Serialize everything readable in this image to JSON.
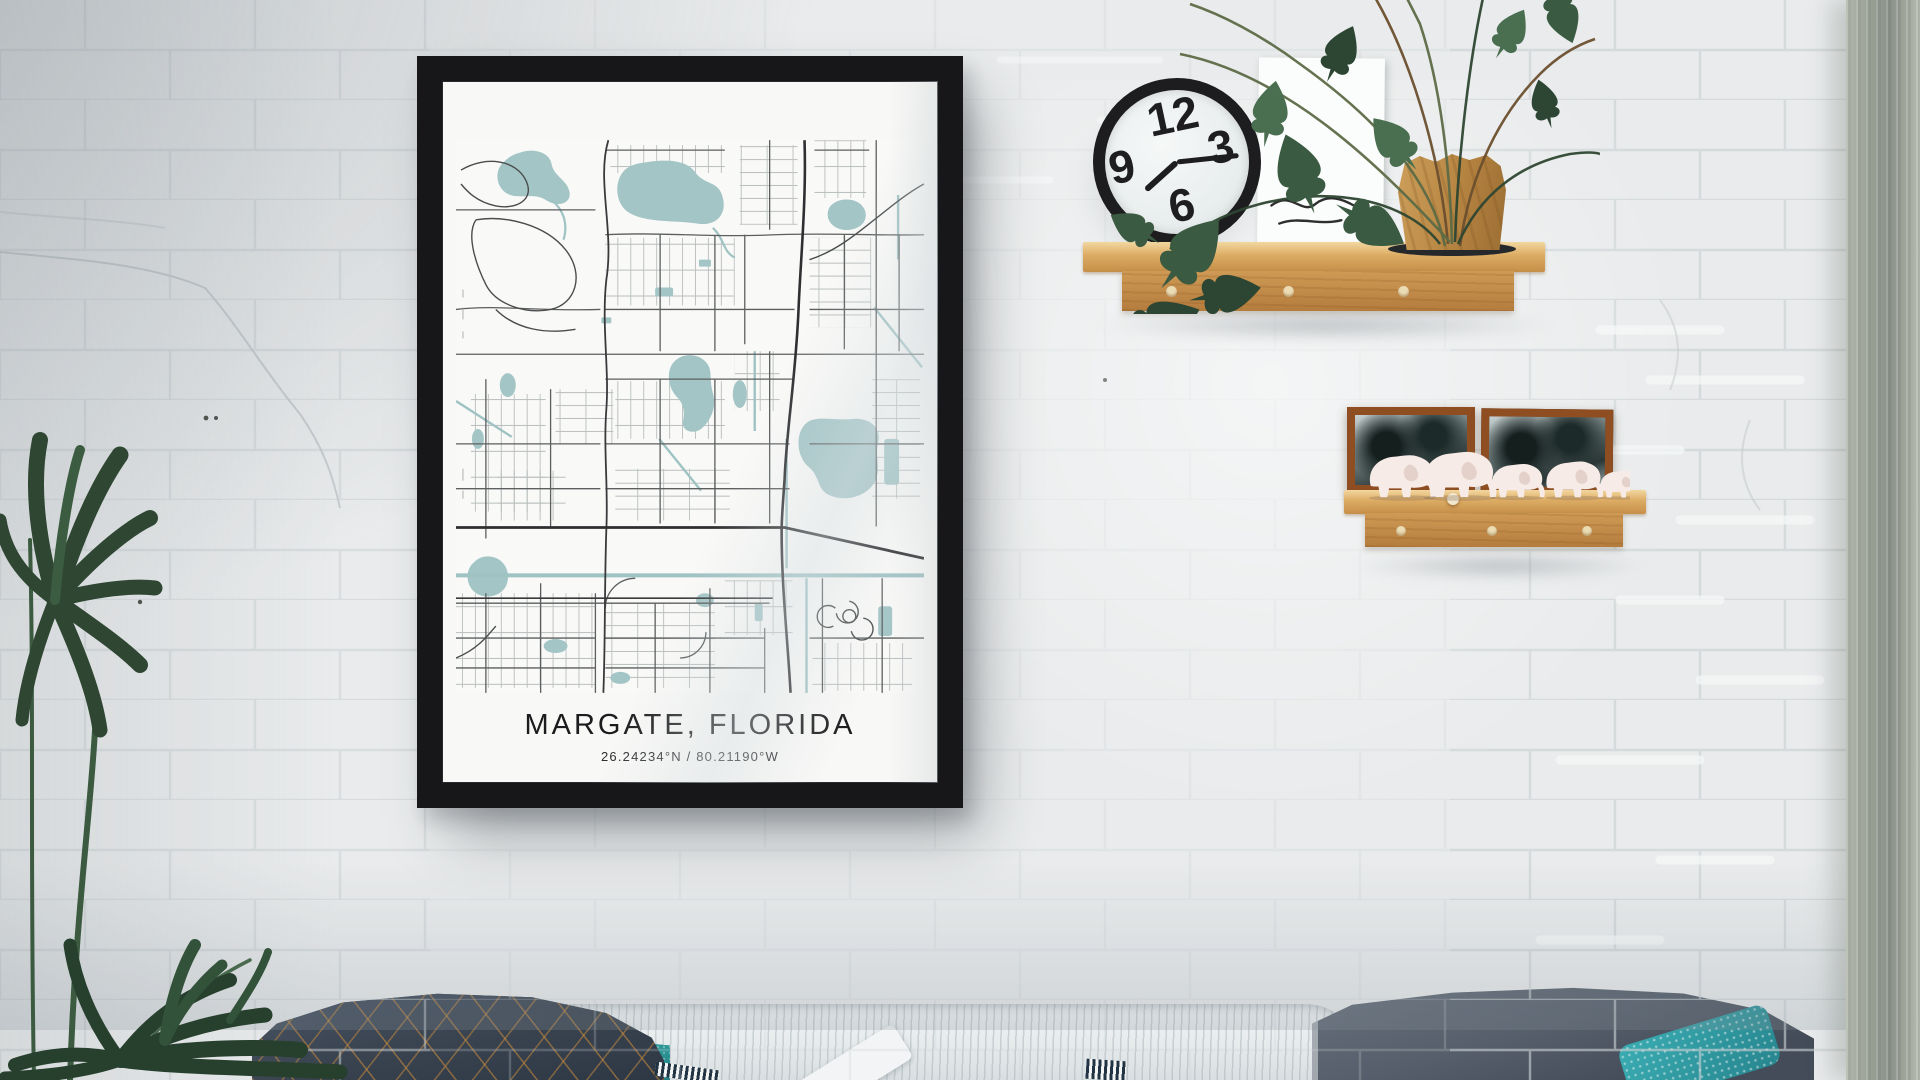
{
  "poster": {
    "title": "MARGATE, FLORIDA",
    "coordinates": "26.24234°N / 80.21190°W",
    "frame_color": "#17171a",
    "paper_color": "#f8f8f6",
    "map": {
      "water_color": "#a3c5c6",
      "major_road_color": "#2f2f31",
      "minor_road_color": "#8e9494",
      "background_color": "#f9f9f7"
    }
  },
  "clock": {
    "numerals": [
      "12",
      "3",
      "6",
      "9"
    ],
    "rim_color": "#1d1d1f",
    "face_color": "#f2f5f4"
  },
  "shelves": {
    "upper_peg_count": 3,
    "lower_peg_count": 3,
    "wood_color": "#cf9a55"
  },
  "figurines": {
    "type": "elephant",
    "count": 5,
    "color": "#f7ebe7"
  },
  "picture_frames": {
    "count": 2,
    "wood_color": "#8f4d22"
  },
  "textiles": {
    "plaid_blanket": "#3a4454",
    "plaid_lines": "#c98a3d",
    "teal_pillow": "#2a9196",
    "white_throw": "#eef1f2",
    "gray_blanket": "#57606c",
    "dotted_pillow": "#2f9da6"
  },
  "wall": {
    "color": "#e9ebec",
    "finish": "painted-brick"
  },
  "curtain": {
    "color": "#979e93"
  }
}
